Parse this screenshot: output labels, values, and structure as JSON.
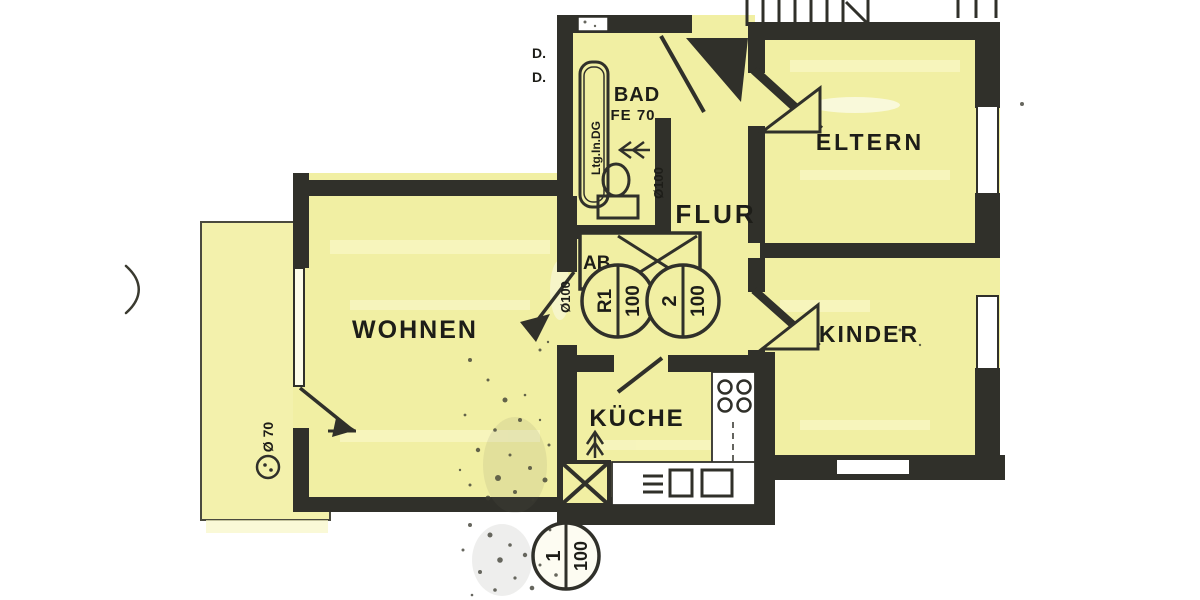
{
  "title": "Scanned apartment floor plan",
  "rooms": [
    {
      "id": "wohnen",
      "label": "WOHNEN"
    },
    {
      "id": "kueche",
      "label": "KÜCHE"
    },
    {
      "id": "flur",
      "label": "FLUR"
    },
    {
      "id": "bad",
      "label": "BAD"
    },
    {
      "id": "eltern",
      "label": "ELTERN"
    },
    {
      "id": "kinder",
      "label": "KINDER"
    }
  ],
  "annotations": {
    "bad_window": "FE 70",
    "shaft_box": "AB.",
    "duct_note": "Ltg.In.DG",
    "pipe_bad": "Ø100",
    "pipe_wohnen_door": "Ø100",
    "terrace_drain": "Ø 70",
    "cut_label_1": "D.",
    "cut_label_2": "D."
  },
  "flues": [
    {
      "id": "R1",
      "size": "100"
    },
    {
      "id": "2",
      "size": "100"
    },
    {
      "id": "1",
      "size": "100"
    }
  ],
  "colors": {
    "room_fill": "#f1efa3",
    "terrace_fill": "#f3f1ac",
    "wall": "#30302a",
    "ink": "#1d1d18",
    "paper": "#ffffff"
  }
}
